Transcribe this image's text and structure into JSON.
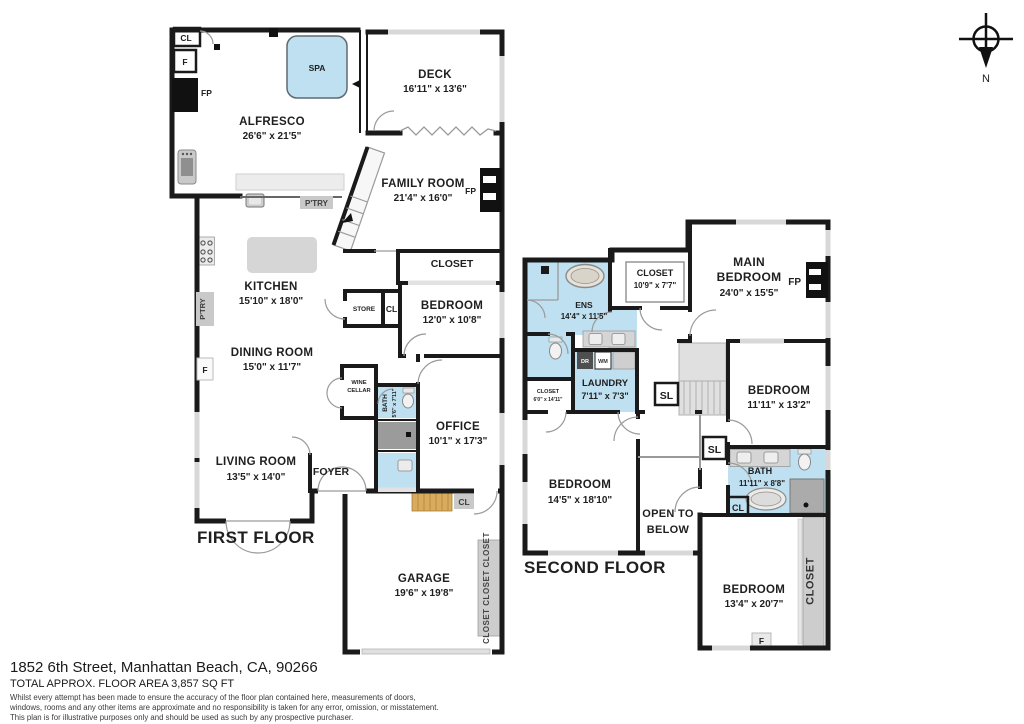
{
  "compass": {
    "label": "N"
  },
  "first_floor": {
    "title": "FIRST FLOOR",
    "rooms": {
      "alfresco": {
        "name": "ALFRESCO",
        "dims": "26'6\" x 21'5\""
      },
      "spa": {
        "name": "SPA"
      },
      "deck": {
        "name": "DECK",
        "dims": "16'11\" x 13'6\""
      },
      "family_room": {
        "name": "FAMILY ROOM",
        "dims": "21'4\" x 16'0\""
      },
      "kitchen": {
        "name": "KITCHEN",
        "dims": "15'10\" x 18'0\""
      },
      "dining_room": {
        "name": "DINING ROOM",
        "dims": "15'0\" x 11'7\""
      },
      "living_room": {
        "name": "LIVING ROOM",
        "dims": "13'5\" x 14'0\""
      },
      "bedroom": {
        "name": "BEDROOM",
        "dims": "12'0\" x 10'8\""
      },
      "office": {
        "name": "OFFICE",
        "dims": "10'1\" x 17'3\""
      },
      "bath": {
        "name": "BATH",
        "dims": "5'6\" x 7'11\""
      },
      "foyer": {
        "name": "FOYER"
      },
      "garage": {
        "name": "GARAGE",
        "dims": "19'6\" x 19'8\""
      },
      "closet": {
        "name": "CLOSET"
      },
      "store": {
        "name": "STORE"
      },
      "wine_cellar": {
        "line1": "WINE",
        "line2": "CELLAR"
      },
      "pantry": {
        "name": "P'TRY"
      },
      "garage_closets": {
        "name": "CLOSET CLOSET CLOSET"
      }
    },
    "tags": {
      "cl": "CL",
      "f": "F",
      "fp": "FP"
    }
  },
  "second_floor": {
    "title": "SECOND FLOOR",
    "rooms": {
      "main_bedroom": {
        "line1": "MAIN",
        "line2": "BEDROOM",
        "dims": "24'0\" x 15'5\""
      },
      "ens": {
        "name": "ENS",
        "dims": "14'4\" x 11'5\""
      },
      "closet_top": {
        "name": "CLOSET",
        "dims": "10'9\" x 7'7\""
      },
      "laundry": {
        "name": "LAUNDRY",
        "dims": "7'11\" x 7'3\""
      },
      "closet_small": {
        "name": "CLOSET",
        "dims": "6'0\" x 14'11\""
      },
      "bedroom_right": {
        "name": "BEDROOM",
        "dims": "11'11\" x 13'2\""
      },
      "bedroom_left": {
        "name": "BEDROOM",
        "dims": "14'5\" x 18'10\""
      },
      "open_below": {
        "line1": "OPEN TO",
        "line2": "BELOW"
      },
      "bath": {
        "name": "BATH",
        "dims": "11'11\" x 8'8\""
      },
      "bedroom_bottom": {
        "name": "BEDROOM",
        "dims": "13'4\" x 20'7\""
      },
      "closet_side": {
        "name": "CLOSET"
      }
    },
    "tags": {
      "sl": "SL",
      "cl": "CL",
      "f": "F",
      "fp": "FP",
      "dr": "DR",
      "wm": "WM"
    }
  },
  "footer": {
    "address": "1852 6th Street, Manhattan Beach, CA, 90266",
    "area": "TOTAL APPROX. FLOOR AREA 3,857 SQ FT",
    "disclaimer_line1": "Whilst every attempt has been made to ensure the accuracy of the floor plan contained here, measurements of doors,",
    "disclaimer_line2": "windows, rooms and any other items are approximate and no responsibility is taken for any error, omission, or misstatement.",
    "disclaimer_line3": "This plan is for illustrative purposes only and should be used as such by any prospective purchaser."
  },
  "colors": {
    "wall": "#1a1a1a",
    "water": "#bee0f1",
    "wood_stairs": "#d8ab5e",
    "furniture": "#d6d6d6"
  }
}
